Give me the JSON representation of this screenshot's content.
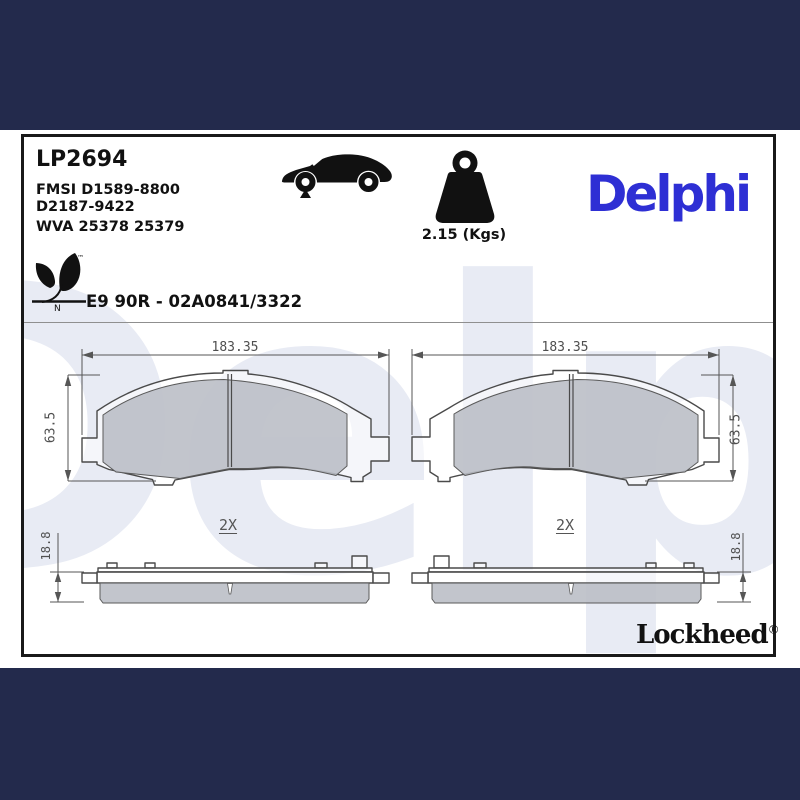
{
  "header": {
    "part_number": "LP2694",
    "fmsi_line1": "FMSI D1589-8800",
    "fmsi_line2": "D2187-9422",
    "wva_line": "WVA 25378 25379",
    "weight_label": "2.15 (Kgs)",
    "brand": "Delphi",
    "approval": "E9 90R - 02A0841/3322"
  },
  "eco": {
    "trademark": "™",
    "n_label": "N"
  },
  "drawing": {
    "width_dim": "183.35",
    "height_dim": "63.5",
    "qty_label": "2X",
    "thickness_dim": "18.8",
    "watermark_text": "Delphi"
  },
  "footer": {
    "brand": "Lockheed",
    "registered": "®"
  },
  "colors": {
    "letterbox_navy": "#232a4c",
    "delphi_blue": "#2e2fd4",
    "friction_gray": "#c2c6cc",
    "line_gray": "#4a4a4a",
    "watermark_blue": "#e8ebf4"
  }
}
